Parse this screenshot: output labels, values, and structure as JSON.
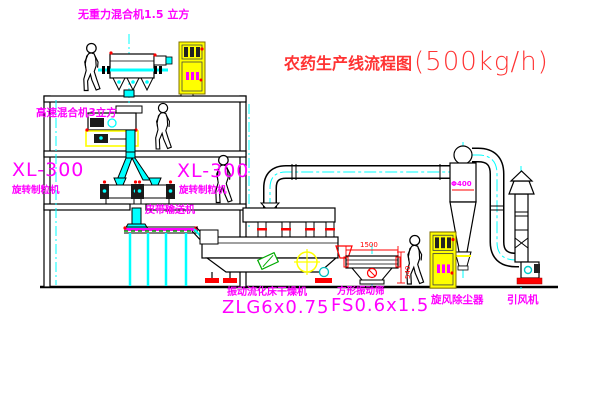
{
  "title": {
    "name": "农药生产线流程图",
    "capacity": "(500kg/h)"
  },
  "labels": {
    "top_mixer": "无重力混合机1.5 立方",
    "high_speed_mixer": "高速混合机3立方",
    "granulator_left_model": "XL-300",
    "granulator_left_name": "旋转制粒机",
    "granulator_right_model": "XL-300",
    "granulator_right_name": "旋转制粒机",
    "belt_conveyor": "皮带输送机",
    "dryer_name": "振动流化床干燥机",
    "dryer_model": "ZLG6x0.75",
    "sieve_name": "方形振动筛",
    "sieve_model": "FS0.6x1.5",
    "cyclone_name": "旋风除尘器",
    "fan_name": "引风机"
  },
  "dimensions": {
    "cyclone_diameter": "Φ400",
    "sieve_length": "1500",
    "sieve_height": "540"
  },
  "colors": {
    "label_magenta": "#ff00ff",
    "title_red": "#ff3333",
    "line_black": "#000000",
    "centerline_cyan": "#00ffff",
    "equipment_yellow": "#ffff00",
    "accent_red": "#ff0000",
    "conveyor_green": "#00aa00"
  }
}
